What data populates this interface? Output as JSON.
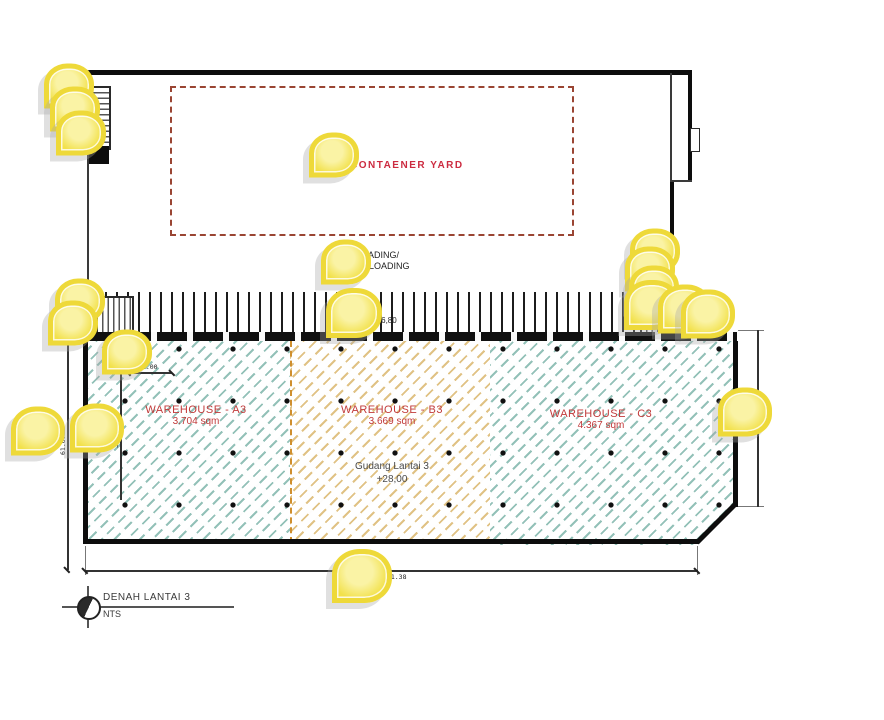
{
  "plan": {
    "container_yard_label": "CONTAENER YARD",
    "loading_label_line1": "LOADING/",
    "loading_label_line2": "UNLOADING",
    "dock_level": "+26,80",
    "zones": [
      {
        "name": "WAREHOUSE - A3",
        "area": "3.704 sqm"
      },
      {
        "name": "WAREHOUSE - B3",
        "area": "3.669 sqm"
      },
      {
        "name": "WAREHOUSE - C3",
        "area": "4.367 sqm"
      }
    ],
    "floor_note_line1": "Gudang Lantai 3",
    "floor_note_line2": "+28,00",
    "dimensions": {
      "inner_width": "12.00",
      "inner_height": "34.00",
      "left_height": "61.07",
      "right_height": "49.28",
      "bottom_width": "181.38"
    },
    "title": "DENAH LANTAI 3",
    "scale": "NTS"
  },
  "colors": {
    "accent_red": "#c13a3a",
    "yard_dash": "#9a4533",
    "hatch_teal": "#3a8e7e",
    "hatch_orange": "#cc9933",
    "wall_black": "#0d0d0d",
    "marker_yellow": "#f2e14b"
  },
  "markers": [
    {
      "x": 69,
      "y": 86
    },
    {
      "x": 75,
      "y": 109
    },
    {
      "x": 81,
      "y": 133
    },
    {
      "x": 334,
      "y": 155
    },
    {
      "x": 346,
      "y": 262
    },
    {
      "x": 354,
      "y": 313,
      "s": 46
    },
    {
      "x": 80,
      "y": 301
    },
    {
      "x": 73,
      "y": 323
    },
    {
      "x": 127,
      "y": 352
    },
    {
      "x": 38,
      "y": 431,
      "s": 44
    },
    {
      "x": 97,
      "y": 428,
      "s": 44
    },
    {
      "x": 655,
      "y": 251
    },
    {
      "x": 650,
      "y": 269
    },
    {
      "x": 654,
      "y": 288
    },
    {
      "x": 652,
      "y": 305,
      "s": 46
    },
    {
      "x": 685,
      "y": 309,
      "s": 44
    },
    {
      "x": 708,
      "y": 314,
      "s": 44
    },
    {
      "x": 745,
      "y": 412,
      "s": 44
    },
    {
      "x": 362,
      "y": 576,
      "s": 50
    }
  ]
}
